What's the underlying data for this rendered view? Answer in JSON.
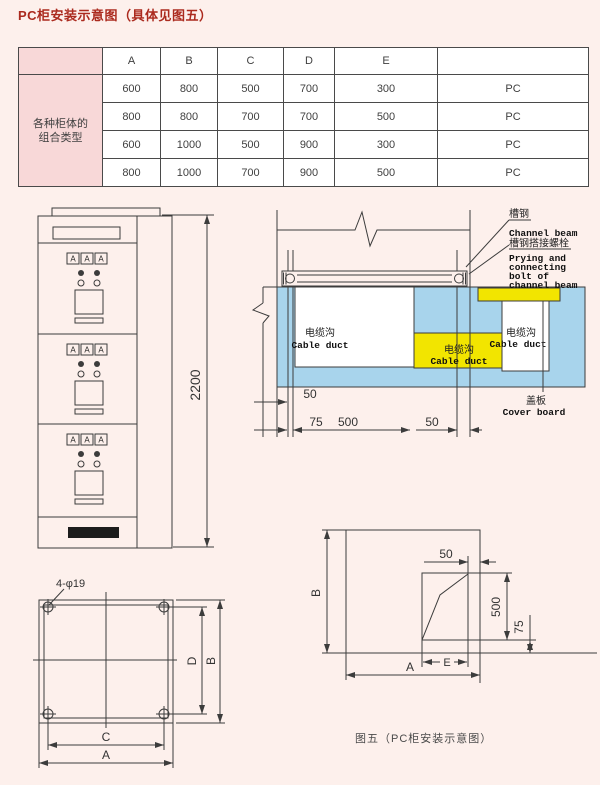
{
  "colors": {
    "page_bg": "#fdf0ec",
    "title_red": "#ab2a1e",
    "table_pink": "#f8d8d8",
    "duct_blue": "#a8d4ec",
    "duct_yellow": "#f2e500",
    "line": "#3c3c3c",
    "text": "#3f3f3f",
    "black_vent": "#1c1c1c"
  },
  "page": {
    "title": "PC柜安装示意图（具体见图五）",
    "caption": "图五（PC柜安装示意图）"
  },
  "table": {
    "columns": [
      "A",
      "B",
      "C",
      "D",
      "E"
    ],
    "row_header": [
      "各种柜体的",
      "组合类型"
    ],
    "rows": [
      [
        "600",
        "800",
        "500",
        "700",
        "300",
        "PC"
      ],
      [
        "800",
        "800",
        "700",
        "700",
        "500",
        "PC"
      ],
      [
        "600",
        "1000",
        "500",
        "900",
        "300",
        "PC"
      ],
      [
        "800",
        "1000",
        "700",
        "900",
        "500",
        "PC"
      ]
    ]
  },
  "front_view": {
    "meter_label": "A",
    "height_dim": "2200"
  },
  "section_view": {
    "channel_beam_cn": "槽钢",
    "channel_beam_en": "Channel beam",
    "bolt_cn": "槽钢搭接螺栓",
    "bolt_en": [
      "Prying and",
      "connecting",
      "bolt of",
      "channel beam"
    ],
    "cover_cn": "盖板",
    "cover_en": "Cover board",
    "duct_cn": "电缆沟",
    "duct_en": "Cable duct",
    "dims": {
      "left_50": "50",
      "left_75": "75",
      "trench_500": "500",
      "right_50": "50"
    }
  },
  "plan_view": {
    "holes_label": "4-φ19",
    "dim_c": "C",
    "dim_a": "A",
    "dim_d": "D",
    "dim_b": "B"
  },
  "detail_view": {
    "dims": {
      "top_50": "50",
      "h_500": "500",
      "h_75": "75",
      "dim_e": "E",
      "dim_a": "A",
      "dim_b": "B"
    }
  }
}
